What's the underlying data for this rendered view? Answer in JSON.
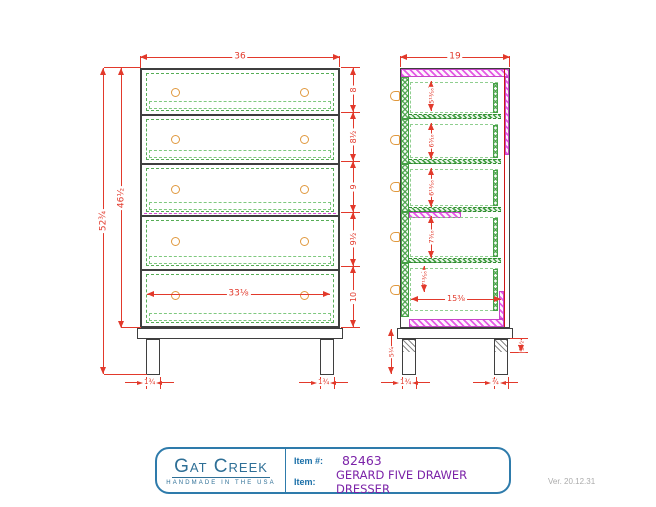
{
  "front_view": {
    "width": "36",
    "overall_height": "52¾",
    "case_height": "46½",
    "drawer_heights": [
      "8",
      "8½",
      "9",
      "9½",
      "10"
    ],
    "inner_width": "33⅛",
    "left_leg_width": "1¾",
    "right_leg_width": "1¾"
  },
  "side_view": {
    "depth": "19",
    "openings": [
      "5¹³⁄₁₆",
      "6⁵⁄₁₆",
      "6¹³⁄₁₆",
      "7⁵⁄₁₆",
      "7¹³⁄₁₆"
    ],
    "inner_depth": "15⅜",
    "leg_height": "5¼",
    "foot_height": "1½",
    "front_leg_depth": "1¾",
    "back_leg_depth": "¾"
  },
  "title_block": {
    "brand": "Gat Creek",
    "brand_tagline": "HANDMADE IN THE USA",
    "item_number_label": "Item #:",
    "item_number": "82463",
    "item_label": "Item:",
    "item_name": "GERARD FIVE DRAWER DRESSER"
  },
  "version": "Ver. 20.12.31",
  "colors": {
    "dimension_red": "#e2392b",
    "drawer_green": "#56ad56",
    "panel_magenta": "#d44ad4",
    "knob_orange": "#e0993f",
    "case_line": "#3f3f3f",
    "brand_blue": "#2e6f96",
    "item_purple": "#7b22a8"
  }
}
